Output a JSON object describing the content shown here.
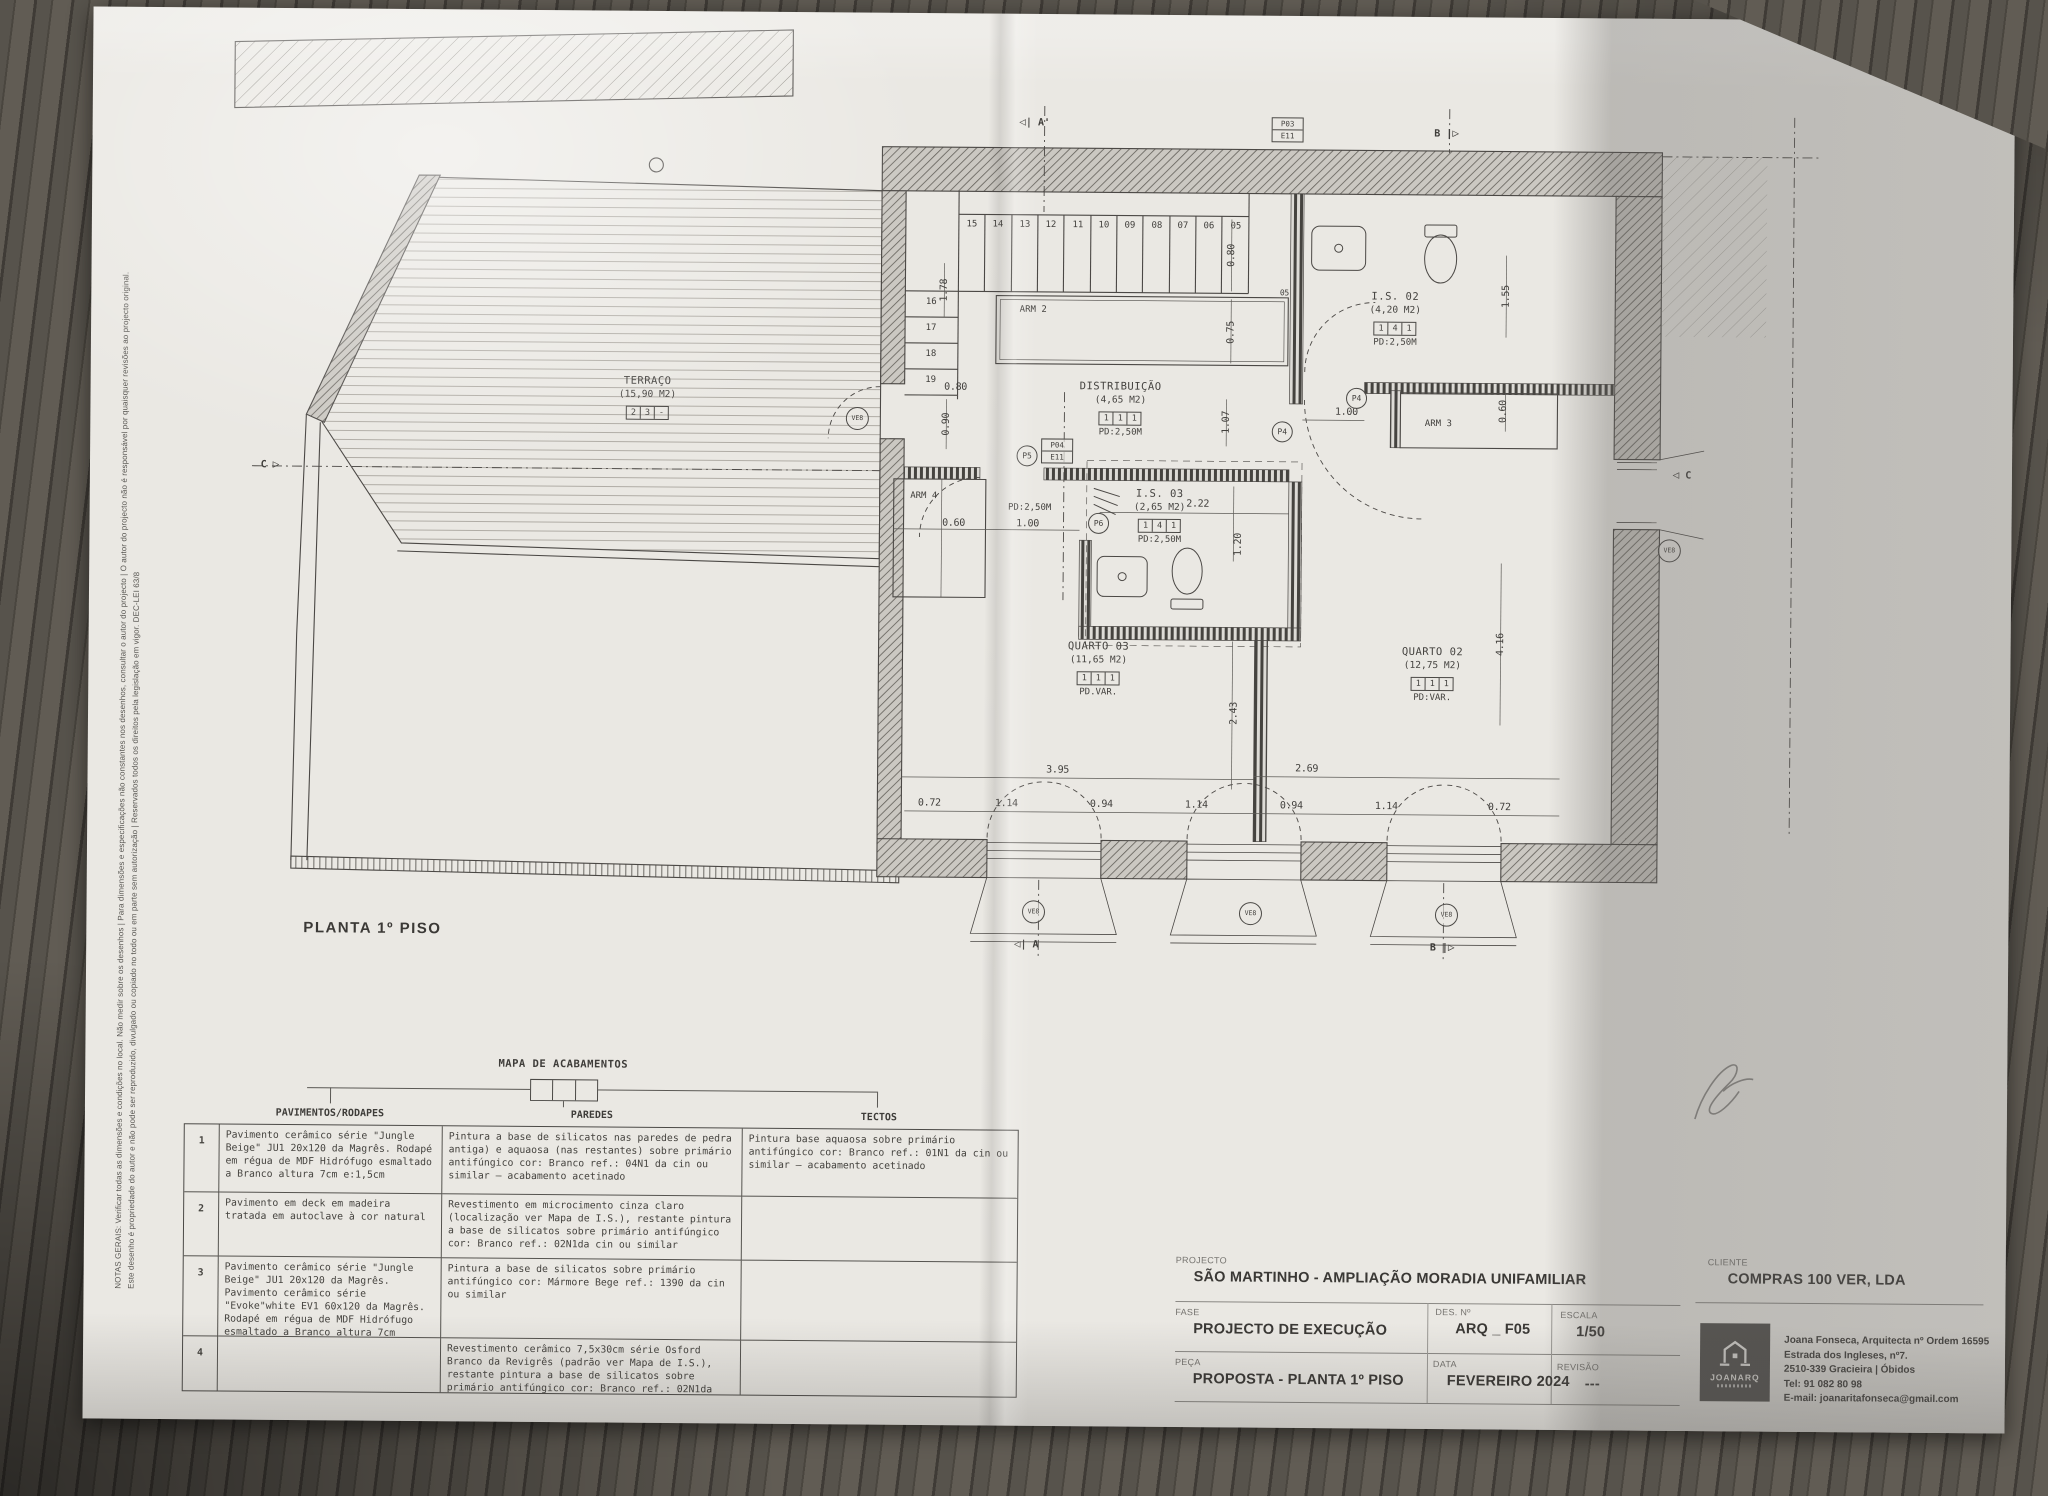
{
  "colors": {
    "wood": "#4a463f",
    "paper": "#eae8e3",
    "paper_shade": "#b9b7b3",
    "ink": "#44423f",
    "wall_hatch": "#5d5a55"
  },
  "notes": {
    "line1": "NOTAS GERAIS: Verificar todas as dimensões e condições no local. Não medir sobre os desenhos | Para dimensões e especificações não constantes nos desenhos, consultar o autor do projecto | O autor do projecto não é responsável por quaisquer revisões ao projecto original.",
    "line2": "Este desenho é propriedade do autor e não pode ser reproduzido, divulgado ou copiado no todo ou em parte sem autorização | Reservados todos os direitos pela legislação em vigor. DEC-LEI 63/8"
  },
  "plan": {
    "caption": "PLANTA 1º PISO",
    "rooms": {
      "terraco": {
        "name": "TERRAÇO",
        "area": "(15,90 M2)",
        "codes": [
          "2",
          "3",
          "-"
        ],
        "pd": ""
      },
      "distribuicao": {
        "name": "DISTRIBUIÇÃO",
        "area": "(4,65 M2)",
        "codes": [
          "1",
          "1",
          "1"
        ],
        "pd": "PD:2,50M"
      },
      "is02": {
        "name": "I.S. 02",
        "area": "(4,20 M2)",
        "codes": [
          "1",
          "4",
          "1"
        ],
        "pd": "PD:2,50M"
      },
      "is03": {
        "name": "I.S. 03",
        "area": "(2,65 M2)",
        "codes": [
          "1",
          "4",
          "1"
        ],
        "pd": "PD:2,50M"
      },
      "quarto03": {
        "name": "QUARTO 03",
        "area": "(11,65 M2)",
        "codes": [
          "1",
          "1",
          "1"
        ],
        "pd": "PD.VAR."
      },
      "quarto02": {
        "name": "QUARTO 02",
        "area": "(12,75 M2)",
        "codes": [
          "1",
          "1",
          "1"
        ],
        "pd": "PD:VAR."
      }
    },
    "closets": {
      "arm2": "ARM 2",
      "arm3": "ARM 3",
      "arm4": "ARM 4",
      "arm4_pd": "PD:2,50M"
    },
    "stairs": {
      "top": [
        "15",
        "14",
        "13",
        "12",
        "11",
        "10",
        "09",
        "08",
        "07",
        "06",
        "05"
      ],
      "left": [
        "16",
        "17",
        "18",
        "19"
      ]
    },
    "tags": {
      "p04": "P04",
      "e11": "E11",
      "p03": "P03",
      "p4": "P4",
      "p5": "P5",
      "p6": "P6",
      "ve8": "VE8",
      "n05": "05"
    },
    "markers": {
      "a": "A",
      "a_prime": "A'",
      "b": "B",
      "c": "C"
    },
    "dims": {
      "v178": "1.78",
      "v080a": "0.80",
      "v075": "0.75",
      "v080b": "0.80",
      "v090": "0.90",
      "v107": "1.07",
      "v155": "1.55",
      "v100a": "1.00",
      "v060a": "0.60",
      "v060b": "0.60",
      "v100b": "1.00",
      "v222": "2.22",
      "v120": "1.20",
      "v243": "2.43",
      "v416": "4.16",
      "v395": "3.95",
      "v269": "2.69",
      "bottom": [
        "0.72",
        "1.14",
        "0.94",
        "1.14",
        "0.94",
        "1.14",
        "0.72"
      ]
    }
  },
  "finishes": {
    "title": "MAPA DE ACABAMENTOS",
    "columns": [
      "PAVIMENTOS/RODAPES",
      "PAREDES",
      "TECTOS"
    ],
    "rows": [
      {
        "num": "1",
        "pav": "Pavimento cerâmico série \"Jungle Beige\" JU1 20x120 da Magrês. Rodapé em régua de MDF Hidrófugo esmaltado a Branco altura 7cm e:1,5cm",
        "par": "Pintura a base de silicatos nas paredes de pedra antiga) e aquaosa (nas restantes) sobre primário antifúngico cor: Branco ref.: 04N1 da cin ou similar – acabamento acetinado",
        "tec": "Pintura base aquaosa sobre primário antifúngico cor: Branco ref.: 01N1 da cin ou similar – acabamento acetinado"
      },
      {
        "num": "2",
        "pav": "Pavimento em deck em madeira tratada em autoclave à cor natural",
        "par": "Revestimento em microcimento cinza claro (localização ver Mapa de I.S.), restante pintura a base de silicatos sobre primário antifúngico cor: Branco ref.: 02N1da cin ou similar",
        "tec": ""
      },
      {
        "num": "3",
        "pav": "Pavimento cerâmico série \"Jungle Beige\" JU1 20x120 da Magrês. Pavimento cerâmico série \"Evoke\"white EV1 60x120 da Magrês. Rodapé em régua de MDF Hidrófugo esmaltado a Branco altura 7cm e:1,5cm",
        "par": "Pintura a base de silicatos sobre primário antifúngico cor: Mármore Bege ref.: 1390 da cin ou similar",
        "tec": ""
      },
      {
        "num": "4",
        "pav": "",
        "par": "Revestimento cerâmico 7,5x30cm série Osford Branco da Revigrês (padrão ver Mapa de I.S.), restante pintura a base de silicatos sobre primário antifúngico cor: Branco ref.: 02N1da cin ou similar",
        "tec": ""
      }
    ]
  },
  "title_block": {
    "projecto_label": "PROJECTO",
    "projecto": "SÃO MARTINHO - AMPLIAÇÃO MORADIA UNIFAMILIAR",
    "fase_label": "FASE",
    "fase": "PROJECTO DE EXECUÇÃO",
    "peca_label": "PEÇA",
    "peca": "PROPOSTA - PLANTA 1º PISO",
    "des_label": "DES. Nº",
    "des": "ARQ _ F05",
    "data_label": "DATA",
    "data": "FEVEREIRO 2024",
    "escala_label": "ESCALA",
    "escala": "1/50",
    "revisao_label": "REVISÃO",
    "revisao": "---",
    "cliente_label": "CLIENTE",
    "cliente": "COMPRAS 100 VER, LDA",
    "logo_text": "JOANARQ",
    "contact": [
      "Joana Fonseca, Arquitecta nº Ordem 16595",
      "Estrada dos Ingleses, nº7.",
      "2510-339 Gracieira | Óbidos",
      "Tel: 91 082 80 98",
      "E-mail: joanaritafonseca@gmail.com"
    ]
  }
}
